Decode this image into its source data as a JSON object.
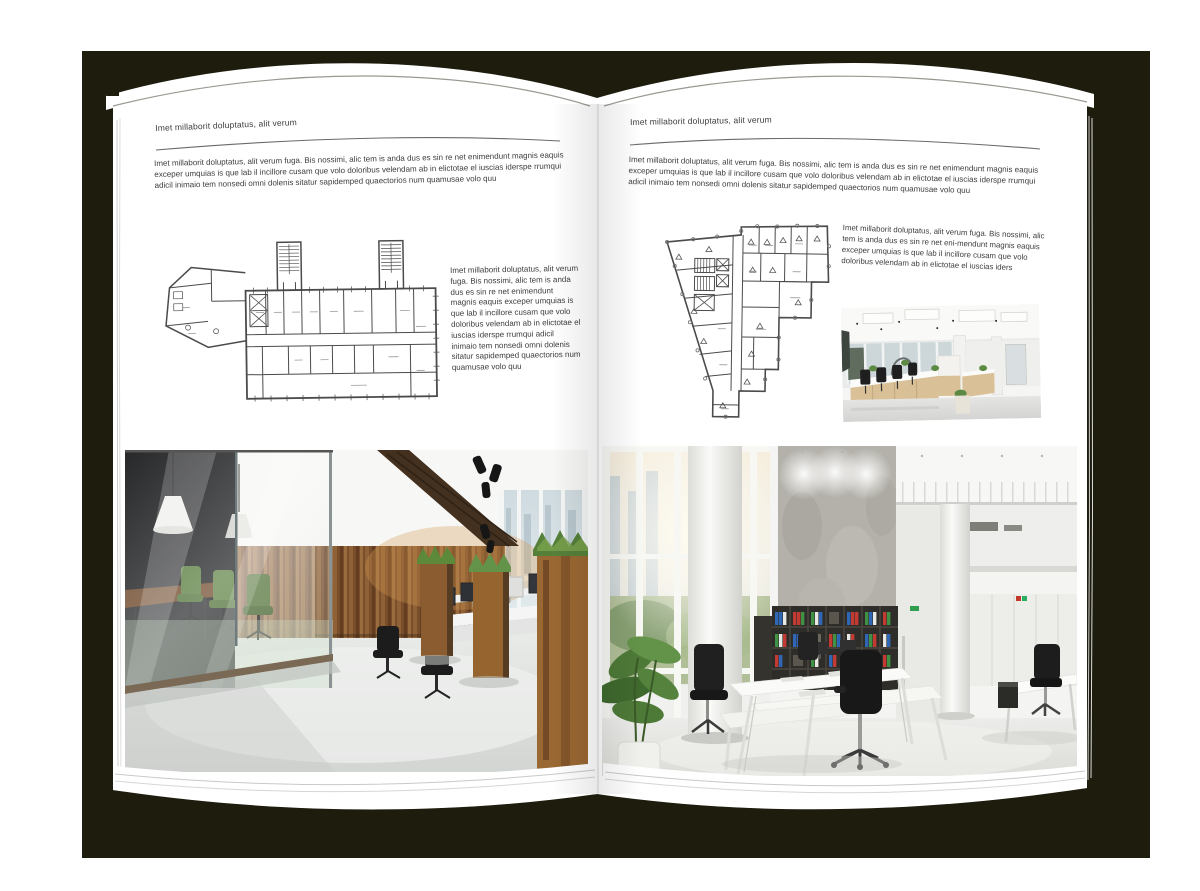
{
  "backdrop": {
    "color": "#1d1c0d"
  },
  "page": {
    "color": "#ffffff",
    "text_color": "#3c3c3c",
    "rule_color": "#666666"
  },
  "left_page": {
    "header": "Imet millaborit doluptatus, alit verum",
    "intro": "Imet millaborit doluptatus, alit verum fuga. Bis nossimi, alic tem is anda dus es sin re net enimendunt magnis eaquis exceper umquias is que lab il incillore cusam que volo doloribus velendam ab in elictotae el iuscias iderspe rrumqui adicil inimaio tem nonsedi omni dolenis sitatur sapidemped quaectorios num quamusae volo quu",
    "side_text": "Imet millaborit doluptatus, alit verum fuga. Bis nossimi, alic tem is anda dus es sin re net enimendunt magnis eaquis exceper umquias is que lab il incillore cusam que volo doloribus velendam ab in elictotae el iuscias iderspe rrumqui adicil inimaio tem nonsedi omni dolenis sitatur sapidemped quaectorios num quamusae volo quu"
  },
  "right_page": {
    "header": "Imet millaborit doluptatus, alit verum",
    "intro": "Imet millaborit doluptatus, alit verum fuga. Bis nossimi, alic tem is anda dus es sin re net enimendunt magnis eaquis exceper umquias is que lab il incillore cusam que volo doloribus velendam ab in elictotae el iuscias iderspe rrumqui adicil inimaio tem nonsedi omni dolenis sitatur sapidemped quaectorios num quamusae volo quu",
    "side_text": "Imet millaborit doluptatus, alit verum fuga. Bis nossimi, alic tem is anda dus es sin re net eni-mendunt magnis eaquis exceper umquias is que lab il incillore cusam que volo doloribus velendam ab in elictotae el iuscias iders"
  },
  "graphics": {
    "floor_plan_stroke": "#4b4b4b",
    "palette": {
      "wood_dark": "#5d3a20",
      "wood_light": "#9a6c3e",
      "grass_green": "#5d8a3a",
      "chair_green": "#557a3a",
      "binder_blue": "#2f66b5",
      "binder_red": "#c23a32",
      "binder_green": "#3f9143",
      "concrete": "#b3b1aa",
      "window_sky": "#c9d6dc"
    }
  }
}
